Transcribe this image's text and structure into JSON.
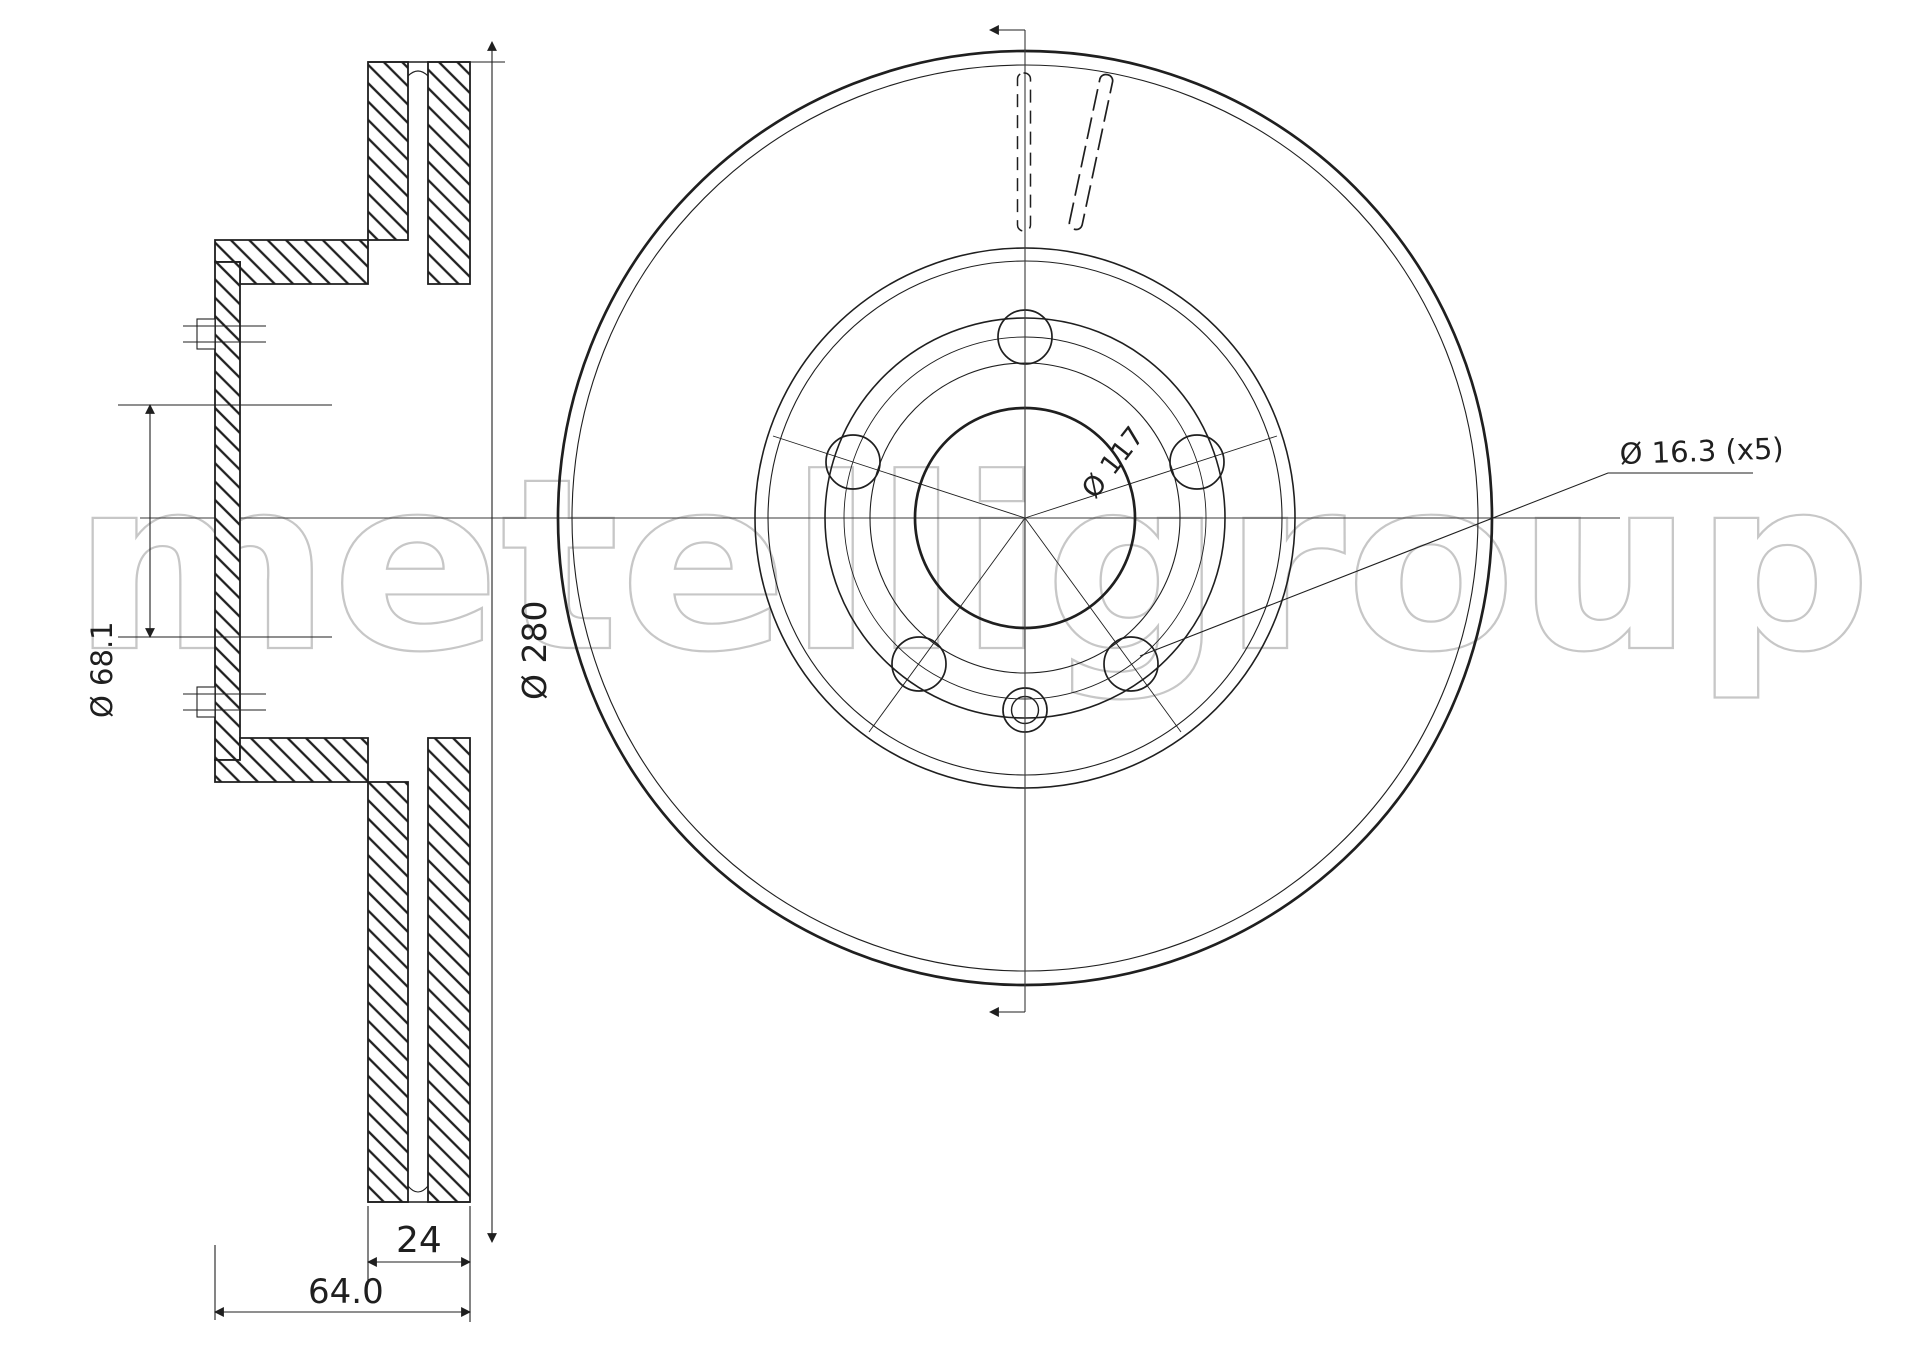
{
  "title": "Brake disc technical drawing",
  "watermark": {
    "text": "metelligroup",
    "color": "#c7c7c7"
  },
  "section_view": {
    "bore_diameter_label": "Ø 68.1",
    "outer_diameter_label": "Ø 280",
    "thickness_label": "24",
    "height_label": "64.0"
  },
  "front_view": {
    "bolt_circle_label": "Ø 117",
    "bolt_hole_label": "Ø 16.3 (x5)",
    "bolt_hole_count": 5
  },
  "colors": {
    "ink": "#1f1f1f",
    "watermark": "#c7c7c7",
    "background": "#ffffff"
  }
}
